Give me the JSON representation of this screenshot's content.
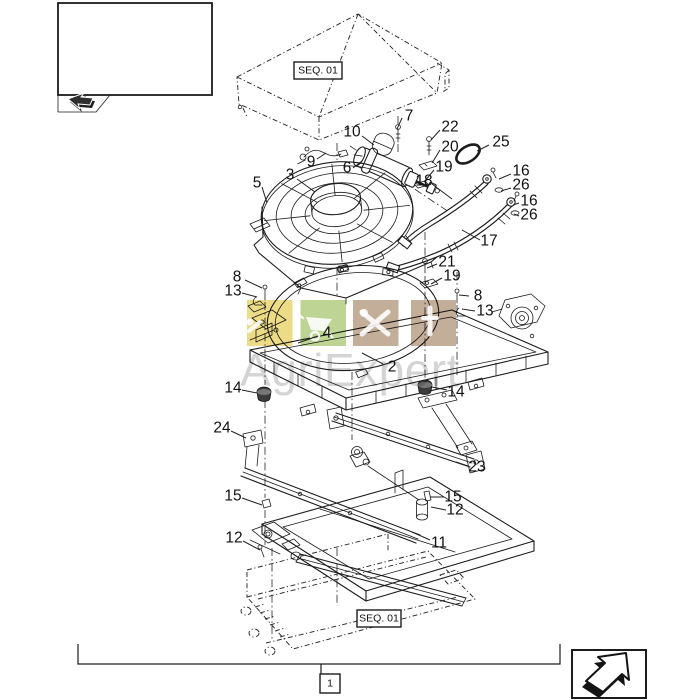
{
  "page": {
    "background": "#ffffff"
  },
  "nav": {
    "prev_box": {
      "icon": "prev-page-arrow-icon"
    },
    "next_box": {
      "icon": "next-page-arrow-icon"
    }
  },
  "diagram": {
    "seq_labels": [
      {
        "text": "SEQ. 01"
      },
      {
        "text": "SEQ. 01"
      }
    ],
    "group_ref": {
      "text": "1"
    },
    "part_labels": [
      {
        "n": "7",
        "x": 409,
        "y": 116,
        "l": [
          402,
          118,
          397,
          129
        ]
      },
      {
        "n": "10",
        "x": 352,
        "y": 132,
        "l": [
          362,
          136,
          374,
          145
        ]
      },
      {
        "n": "22",
        "x": 450,
        "y": 127,
        "l": [
          440,
          130,
          431,
          140
        ]
      },
      {
        "n": "20",
        "x": 450,
        "y": 147,
        "l": [
          440,
          150,
          432,
          163
        ]
      },
      {
        "n": "19",
        "x": 444,
        "y": 167,
        "l": [
          434,
          170,
          424,
          182
        ]
      },
      {
        "n": "25",
        "x": 501,
        "y": 142,
        "l": [
          489,
          145,
          477,
          151
        ]
      },
      {
        "n": "6",
        "x": 347,
        "y": 168,
        "l": [
          353,
          168,
          362,
          161
        ]
      },
      {
        "n": "9",
        "x": 311,
        "y": 162,
        "l": [
          317,
          159,
          326,
          153
        ]
      },
      {
        "n": "3",
        "x": 290,
        "y": 175,
        "l": [
          297,
          179,
          315,
          192
        ]
      },
      {
        "n": "5",
        "x": 257,
        "y": 183,
        "l": [
          262,
          187,
          267,
          203
        ]
      },
      {
        "n": "16",
        "x": 521,
        "y": 171,
        "l": [
          511,
          174,
          499,
          179
        ]
      },
      {
        "n": "26",
        "x": 521,
        "y": 185,
        "l": [
          511,
          188,
          501,
          191
        ]
      },
      {
        "n": "16",
        "x": 529,
        "y": 201,
        "l": [
          519,
          203,
          513,
          205
        ]
      },
      {
        "n": "26",
        "x": 529,
        "y": 215,
        "l": [
          519,
          216,
          514,
          214
        ]
      },
      {
        "n": "18",
        "x": 424,
        "y": 181,
        "l": [
          432,
          184,
          452,
          199
        ]
      },
      {
        "n": "17",
        "x": 489,
        "y": 241,
        "l": [
          480,
          240,
          462,
          230
        ]
      },
      {
        "n": "21",
        "x": 447,
        "y": 262,
        "l": [
          437,
          264,
          427,
          268
        ]
      },
      {
        "n": "19",
        "x": 452,
        "y": 276,
        "l": [
          442,
          278,
          431,
          284
        ]
      },
      {
        "n": "8",
        "x": 478,
        "y": 296,
        "l": [
          469,
          296,
          459,
          295
        ]
      },
      {
        "n": "13",
        "x": 485,
        "y": 311,
        "l": [
          475,
          311,
          462,
          309
        ]
      },
      {
        "n": "8",
        "x": 237,
        "y": 277,
        "l": [
          245,
          280,
          262,
          288
        ]
      },
      {
        "n": "13",
        "x": 233,
        "y": 291,
        "l": [
          242,
          293,
          257,
          297
        ]
      },
      {
        "n": "4",
        "x": 327,
        "y": 333,
        "l": [
          318,
          336,
          298,
          343
        ]
      },
      {
        "n": "2",
        "x": 392,
        "y": 367,
        "l": [
          383,
          364,
          362,
          353
        ]
      },
      {
        "n": "14",
        "x": 233,
        "y": 388,
        "l": [
          242,
          390,
          257,
          393
        ]
      },
      {
        "n": "14",
        "x": 456,
        "y": 392,
        "l": [
          447,
          390,
          432,
          387
        ]
      },
      {
        "n": "24",
        "x": 222,
        "y": 428,
        "l": [
          231,
          431,
          246,
          438
        ]
      },
      {
        "n": "23",
        "x": 477,
        "y": 467,
        "l": [
          468,
          466,
          456,
          462
        ]
      },
      {
        "n": "15",
        "x": 233,
        "y": 496,
        "l": [
          242,
          498,
          262,
          505
        ]
      },
      {
        "n": "12",
        "x": 234,
        "y": 538,
        "l": [
          243,
          541,
          260,
          550
        ]
      },
      {
        "n": "15",
        "x": 453,
        "y": 497,
        "l": [
          444,
          497,
          430,
          497
        ]
      },
      {
        "n": "12",
        "x": 455,
        "y": 510,
        "l": [
          446,
          510,
          431,
          507
        ]
      },
      {
        "n": "11",
        "x": 439,
        "y": 543,
        "l": [
          430,
          540,
          412,
          532
        ]
      }
    ]
  },
  "watermark": {
    "text": "AgriExpert",
    "text_color": "#a9a9a9",
    "squares": [
      {
        "name": "wrench-square",
        "color": "#e8d36c",
        "icon": "wrench-icon"
      },
      {
        "name": "wheelbarrow-square",
        "color": "#afcb7c",
        "icon": "wheelbarrow-icon"
      },
      {
        "name": "tools-square",
        "color": "#b69c82",
        "icon": "hammer-wrench-icon"
      },
      {
        "name": "screwdriver-square",
        "color": "#b69c82",
        "icon": "screwdriver-icon"
      }
    ]
  }
}
